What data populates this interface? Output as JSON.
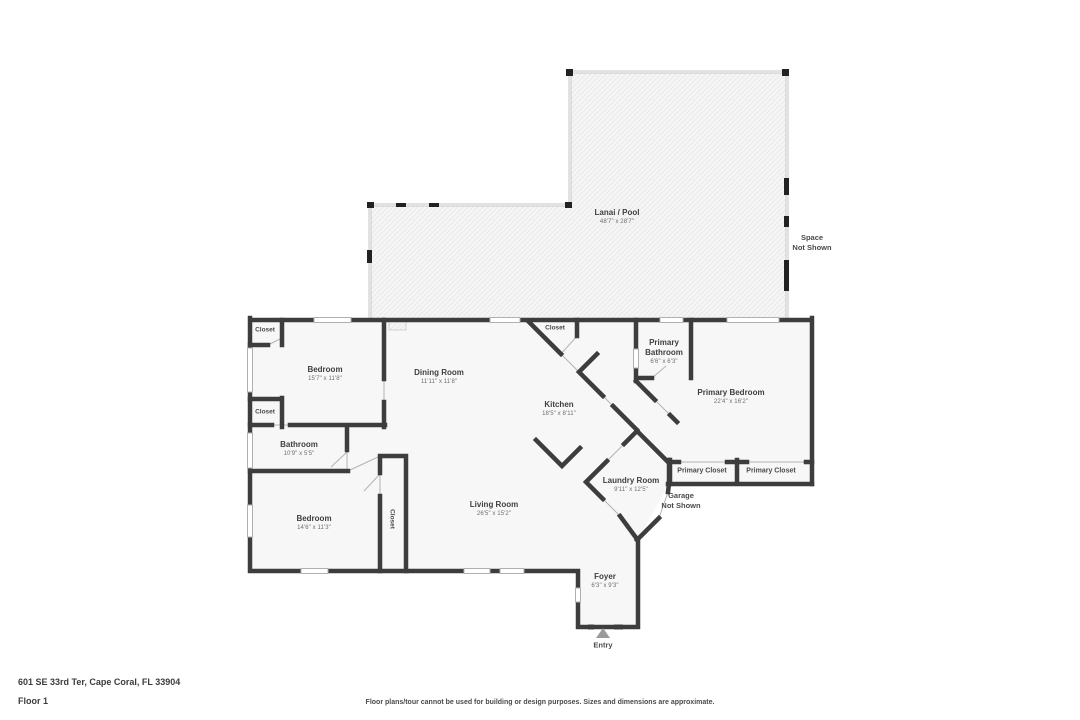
{
  "meta": {
    "address": "601 SE 33rd Ter, Cape Coral, FL 33904",
    "floor": "Floor 1",
    "disclaimer": "Floor plans/tour cannot be used for building or design purposes. Sizes and dimensions are approximate."
  },
  "colors": {
    "wall": "#3d3d3d",
    "room_fill": "#f7f7f7",
    "lanai_outline": "#c6c6c6",
    "thin_line": "#b3b3b3",
    "text_primary": "#3f3f3f",
    "text_secondary": "#6e6e6e",
    "entry_arrow": "#9a9a9a"
  },
  "rooms": {
    "lanai": {
      "name": "Lanai / Pool",
      "dims": "48'7\" x 28'7\""
    },
    "bedroom_top": {
      "name": "Bedroom",
      "dims": "15'7\" x 11'8\""
    },
    "dining_room": {
      "name": "Dining Room",
      "dims": "11'11\" x 11'8\""
    },
    "kitchen": {
      "name": "Kitchen",
      "dims": "18'5\" x 8'11\""
    },
    "primary_bathroom": {
      "name": "Primary Bathroom",
      "dims": "6'6\" x 6'3\""
    },
    "primary_bedroom": {
      "name": "Primary Bedroom",
      "dims": "22'4\" x 16'2\""
    },
    "bathroom": {
      "name": "Bathroom",
      "dims": "10'9\" x 5'5\""
    },
    "bedroom_bottom": {
      "name": "Bedroom",
      "dims": "14'6\" x 11'3\""
    },
    "living_room": {
      "name": "Living Room",
      "dims": "26'5\" x 15'2\""
    },
    "laundry_room": {
      "name": "Laundry Room",
      "dims": "9'11\" x 12'5\""
    },
    "foyer": {
      "name": "Foyer",
      "dims": "6'3\" x 9'3\""
    }
  },
  "closets": {
    "top_left": "Closet",
    "mid_left": "Closet",
    "hall": "Closet",
    "vertical": "Closet",
    "primary_1": "Primary Closet",
    "primary_2": "Primary Closet"
  },
  "annotations": {
    "space_line1": "Space",
    "space_line2": "Not Shown",
    "garage_line1": "Garage",
    "garage_line2": "Not Shown",
    "entry": "Entry"
  }
}
